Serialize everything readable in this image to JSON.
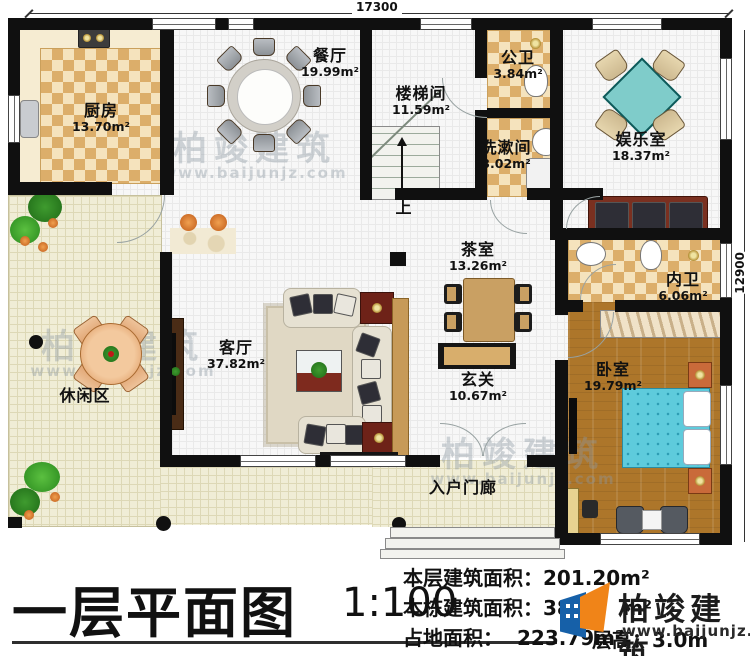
{
  "title": {
    "text": "一层平面图",
    "scale": "1:100"
  },
  "dimensions": {
    "top": "17300",
    "right": "12900"
  },
  "rooms": [
    {
      "name": "厨房",
      "area": "13.70m²"
    },
    {
      "name": "餐厅",
      "area": "19.99m²"
    },
    {
      "name": "楼梯间",
      "area": "11.59m²"
    },
    {
      "name": "公卫",
      "area": "3.84m²"
    },
    {
      "name": "洗漱间",
      "area": "3.02m²"
    },
    {
      "name": "娱乐室",
      "area": "18.37m²"
    },
    {
      "name": "茶室",
      "area": "13.26m²"
    },
    {
      "name": "内卫",
      "area": "6.06m²"
    },
    {
      "name": "客厅",
      "area": "37.82m²"
    },
    {
      "name": "玄关",
      "area": "10.67m²"
    },
    {
      "name": "卧室",
      "area": "19.79m²"
    },
    {
      "name": "休闲区",
      "area": ""
    },
    {
      "name": "入户门廊",
      "area": ""
    }
  ],
  "stairs": {
    "up_label": "上"
  },
  "info": {
    "lines": [
      {
        "label": "本层建筑面积：",
        "value": "201.20m²"
      },
      {
        "label": "本栋建筑面积：",
        "value": "387.",
        "unit": "m²"
      },
      {
        "label": "占地面积：",
        "value": "223.79m²"
      }
    ],
    "floor_height": "层高：3.0m"
  },
  "brand": {
    "name": "柏竣建筑",
    "url": "www.baijunjz.com"
  },
  "watermark": {
    "name": "柏竣建筑",
    "url": "www.baijunjz.com"
  },
  "colors": {
    "wall": "#101010",
    "tile": "#dcae6a",
    "wood": "#ad762a",
    "table_teal": "#7fccca",
    "bed_teal": "#5ecbdc",
    "deck": "#f0edd6",
    "logo_blue": "#1660a8",
    "logo_orange": "#f08418"
  }
}
